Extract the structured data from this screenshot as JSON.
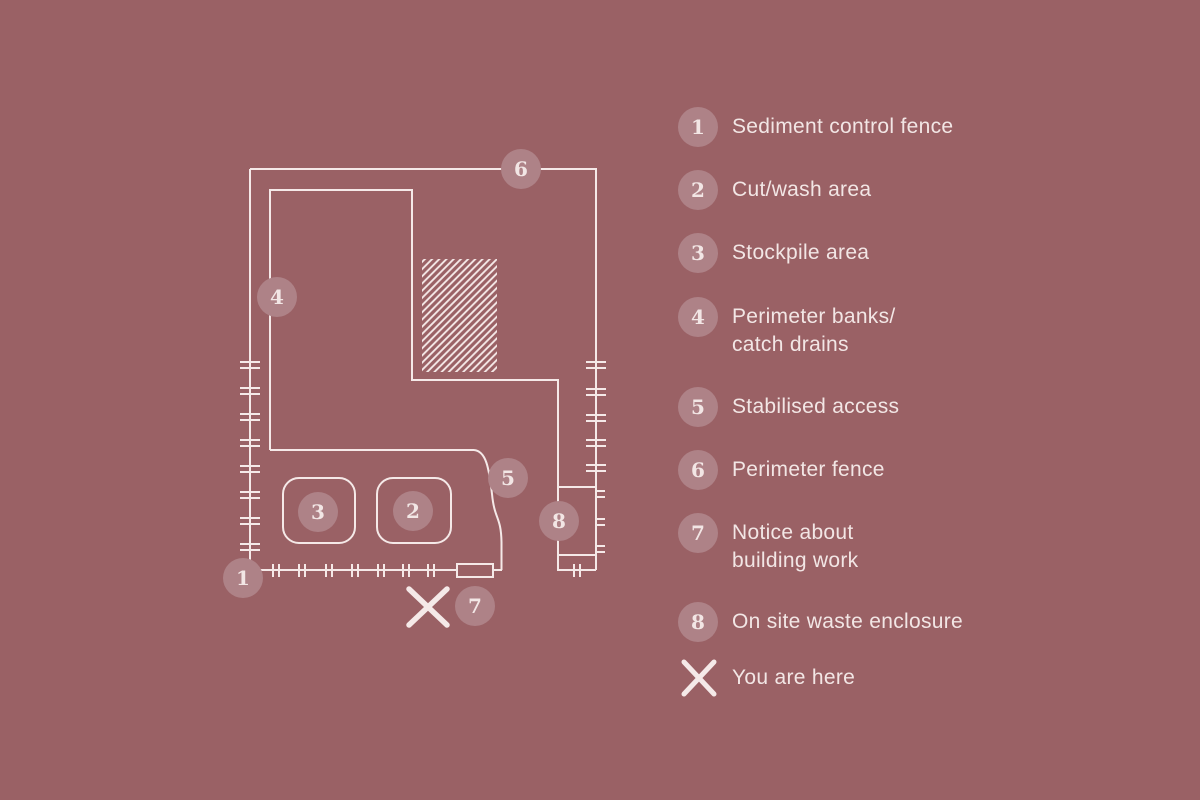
{
  "canvas": {
    "background": "#9a6165",
    "line_color": "#f5e9e8",
    "badge_fill": "#ae8287",
    "text_color": "#f2e6e5"
  },
  "legend": {
    "items": [
      {
        "id": "1",
        "label": "Sediment control fence"
      },
      {
        "id": "2",
        "label": "Cut/wash area"
      },
      {
        "id": "3",
        "label": "Stockpile area"
      },
      {
        "id": "4",
        "label": "Perimeter banks/\ncatch drains"
      },
      {
        "id": "5",
        "label": "Stabilised access"
      },
      {
        "id": "6",
        "label": "Perimeter fence"
      },
      {
        "id": "7",
        "label": "Notice about\nbuilding work"
      },
      {
        "id": "8",
        "label": "On site waste enclosure"
      },
      {
        "id": "x",
        "label": "You are here",
        "symbol": "x-marker"
      }
    ]
  },
  "plan": {
    "markers": [
      {
        "id": "1",
        "name": "sediment-control-fence",
        "x": 243,
        "y": 578
      },
      {
        "id": "2",
        "name": "cut-wash-area",
        "x": 413,
        "y": 511
      },
      {
        "id": "3",
        "name": "stockpile-area",
        "x": 318,
        "y": 512
      },
      {
        "id": "4",
        "name": "perimeter-banks-catch-drains",
        "x": 277,
        "y": 297
      },
      {
        "id": "5",
        "name": "stabilised-access",
        "x": 508,
        "y": 478
      },
      {
        "id": "6",
        "name": "perimeter-fence",
        "x": 521,
        "y": 169
      },
      {
        "id": "7",
        "name": "notice-about-building-work",
        "x": 475,
        "y": 606
      },
      {
        "id": "8",
        "name": "on-site-waste-enclosure",
        "x": 559,
        "y": 521
      }
    ],
    "you_are_here": {
      "x": 428,
      "y": 607
    }
  }
}
